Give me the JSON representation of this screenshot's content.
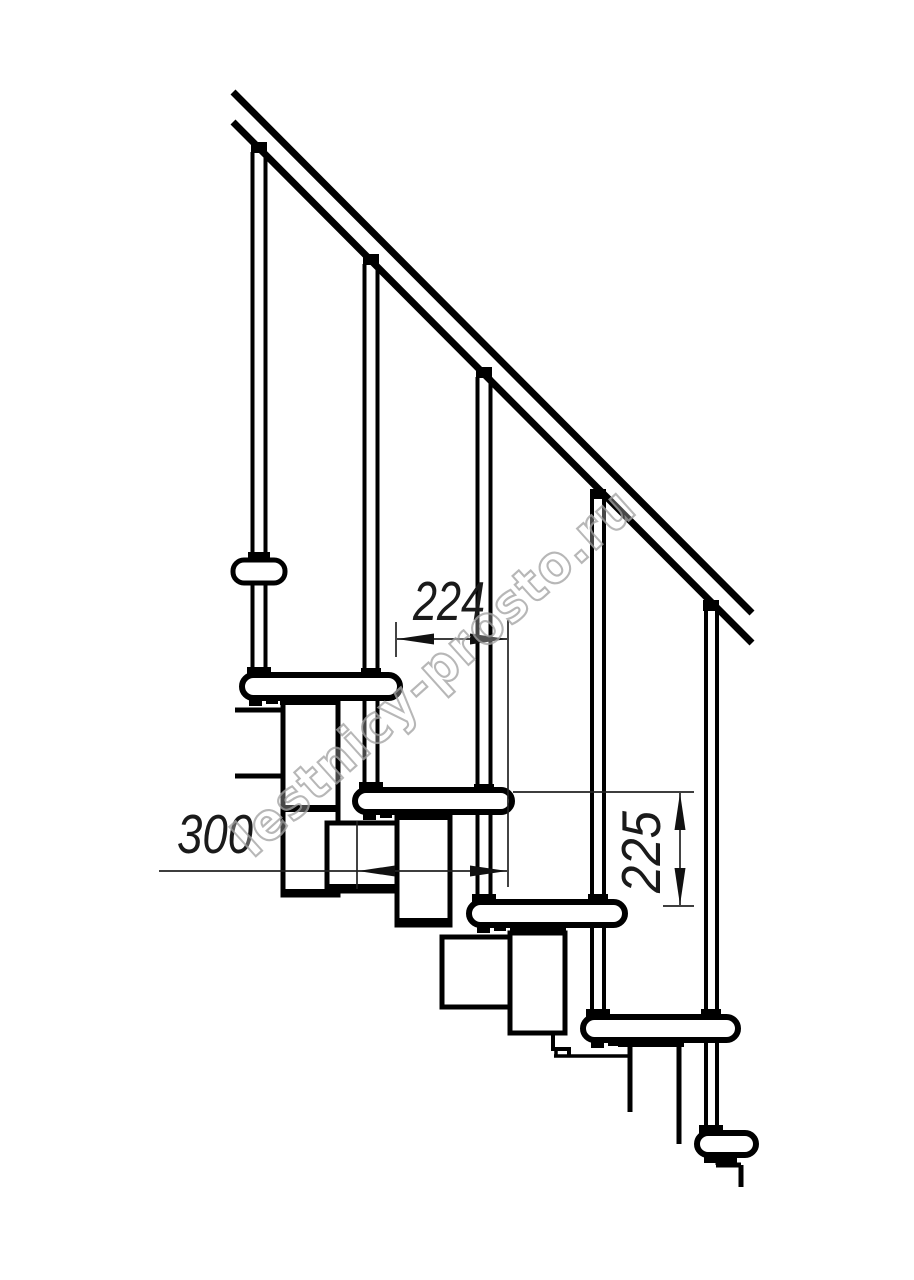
{
  "drawing": {
    "title": "modular-staircase-side-view",
    "dimensions": {
      "step_offset": "224",
      "tread_depth": "300",
      "riser_height": "225"
    },
    "watermark": {
      "text": "lestnicy-prosto.ru"
    },
    "colors": {
      "line": "#000000",
      "dimension": "#222222",
      "watermark_outline": "#a6a6a6",
      "background": "#ffffff"
    }
  }
}
